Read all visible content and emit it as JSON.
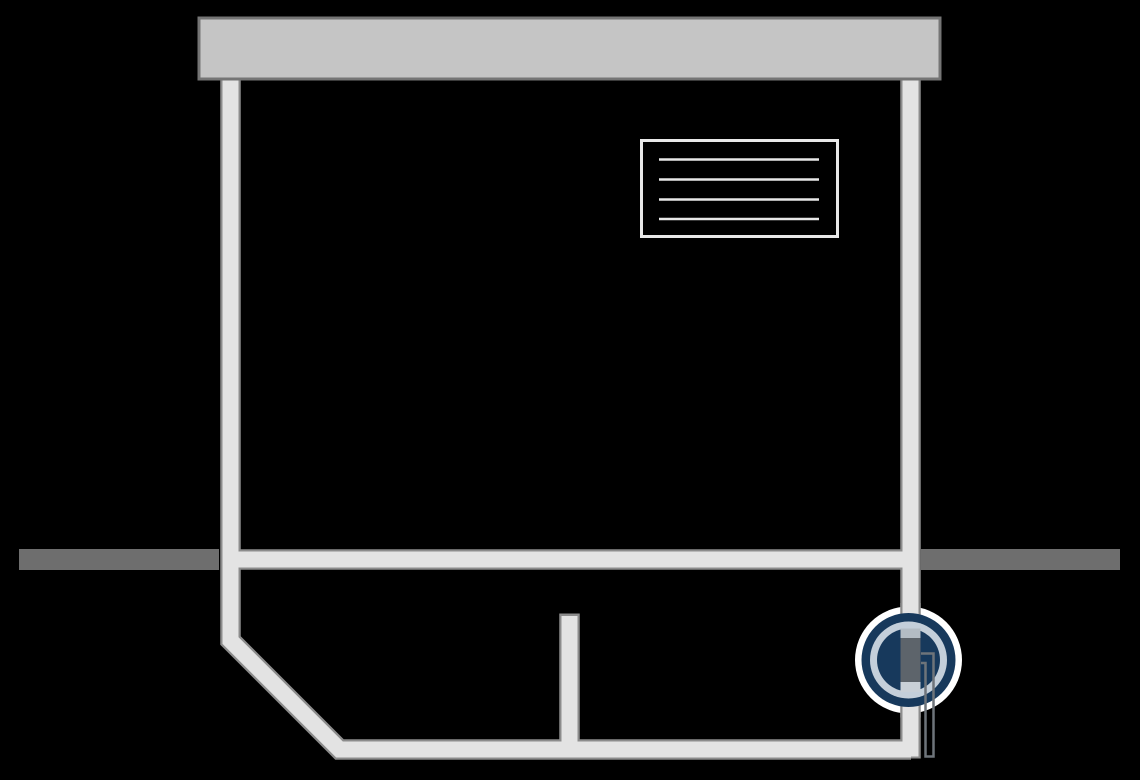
{
  "diagram": {
    "kind": "illustration",
    "name": "house-cross-section-sewer-backwater-valve",
    "parts": [
      {
        "name": "roof-slab"
      },
      {
        "name": "left-wall-pipe"
      },
      {
        "name": "right-wall-pipe"
      },
      {
        "name": "ground-line-left"
      },
      {
        "name": "ground-line-right"
      },
      {
        "name": "ground-level-interior-pipe"
      },
      {
        "name": "window-label-box",
        "placeholder_lines": 4
      },
      {
        "name": "floor-drain-stub-pipe"
      },
      {
        "name": "basement-floor-pipe"
      },
      {
        "name": "basement-wall-diagonal"
      },
      {
        "name": "valve-detail-circle"
      },
      {
        "name": "backwater-valve-body"
      },
      {
        "name": "backwater-valve-handle"
      }
    ]
  },
  "colors": {
    "background": "#000000",
    "roof_fill": "#c5c5c5",
    "roof_border": "#757575",
    "pipe_fill": "#e3e3e3",
    "pipe_border": "#8c8c8c",
    "ground": "#6e6e6e",
    "label_line": "#e8e8e8",
    "navy": "#17395c",
    "ring_light": "#c4cfda",
    "ring_white": "#ffffff",
    "pipe_tint_upper": "#b3bcc4",
    "pipe_tint_lower": "#c9d0d7",
    "valve_body": "#5d646b",
    "valve_handle": "#6e747a"
  }
}
